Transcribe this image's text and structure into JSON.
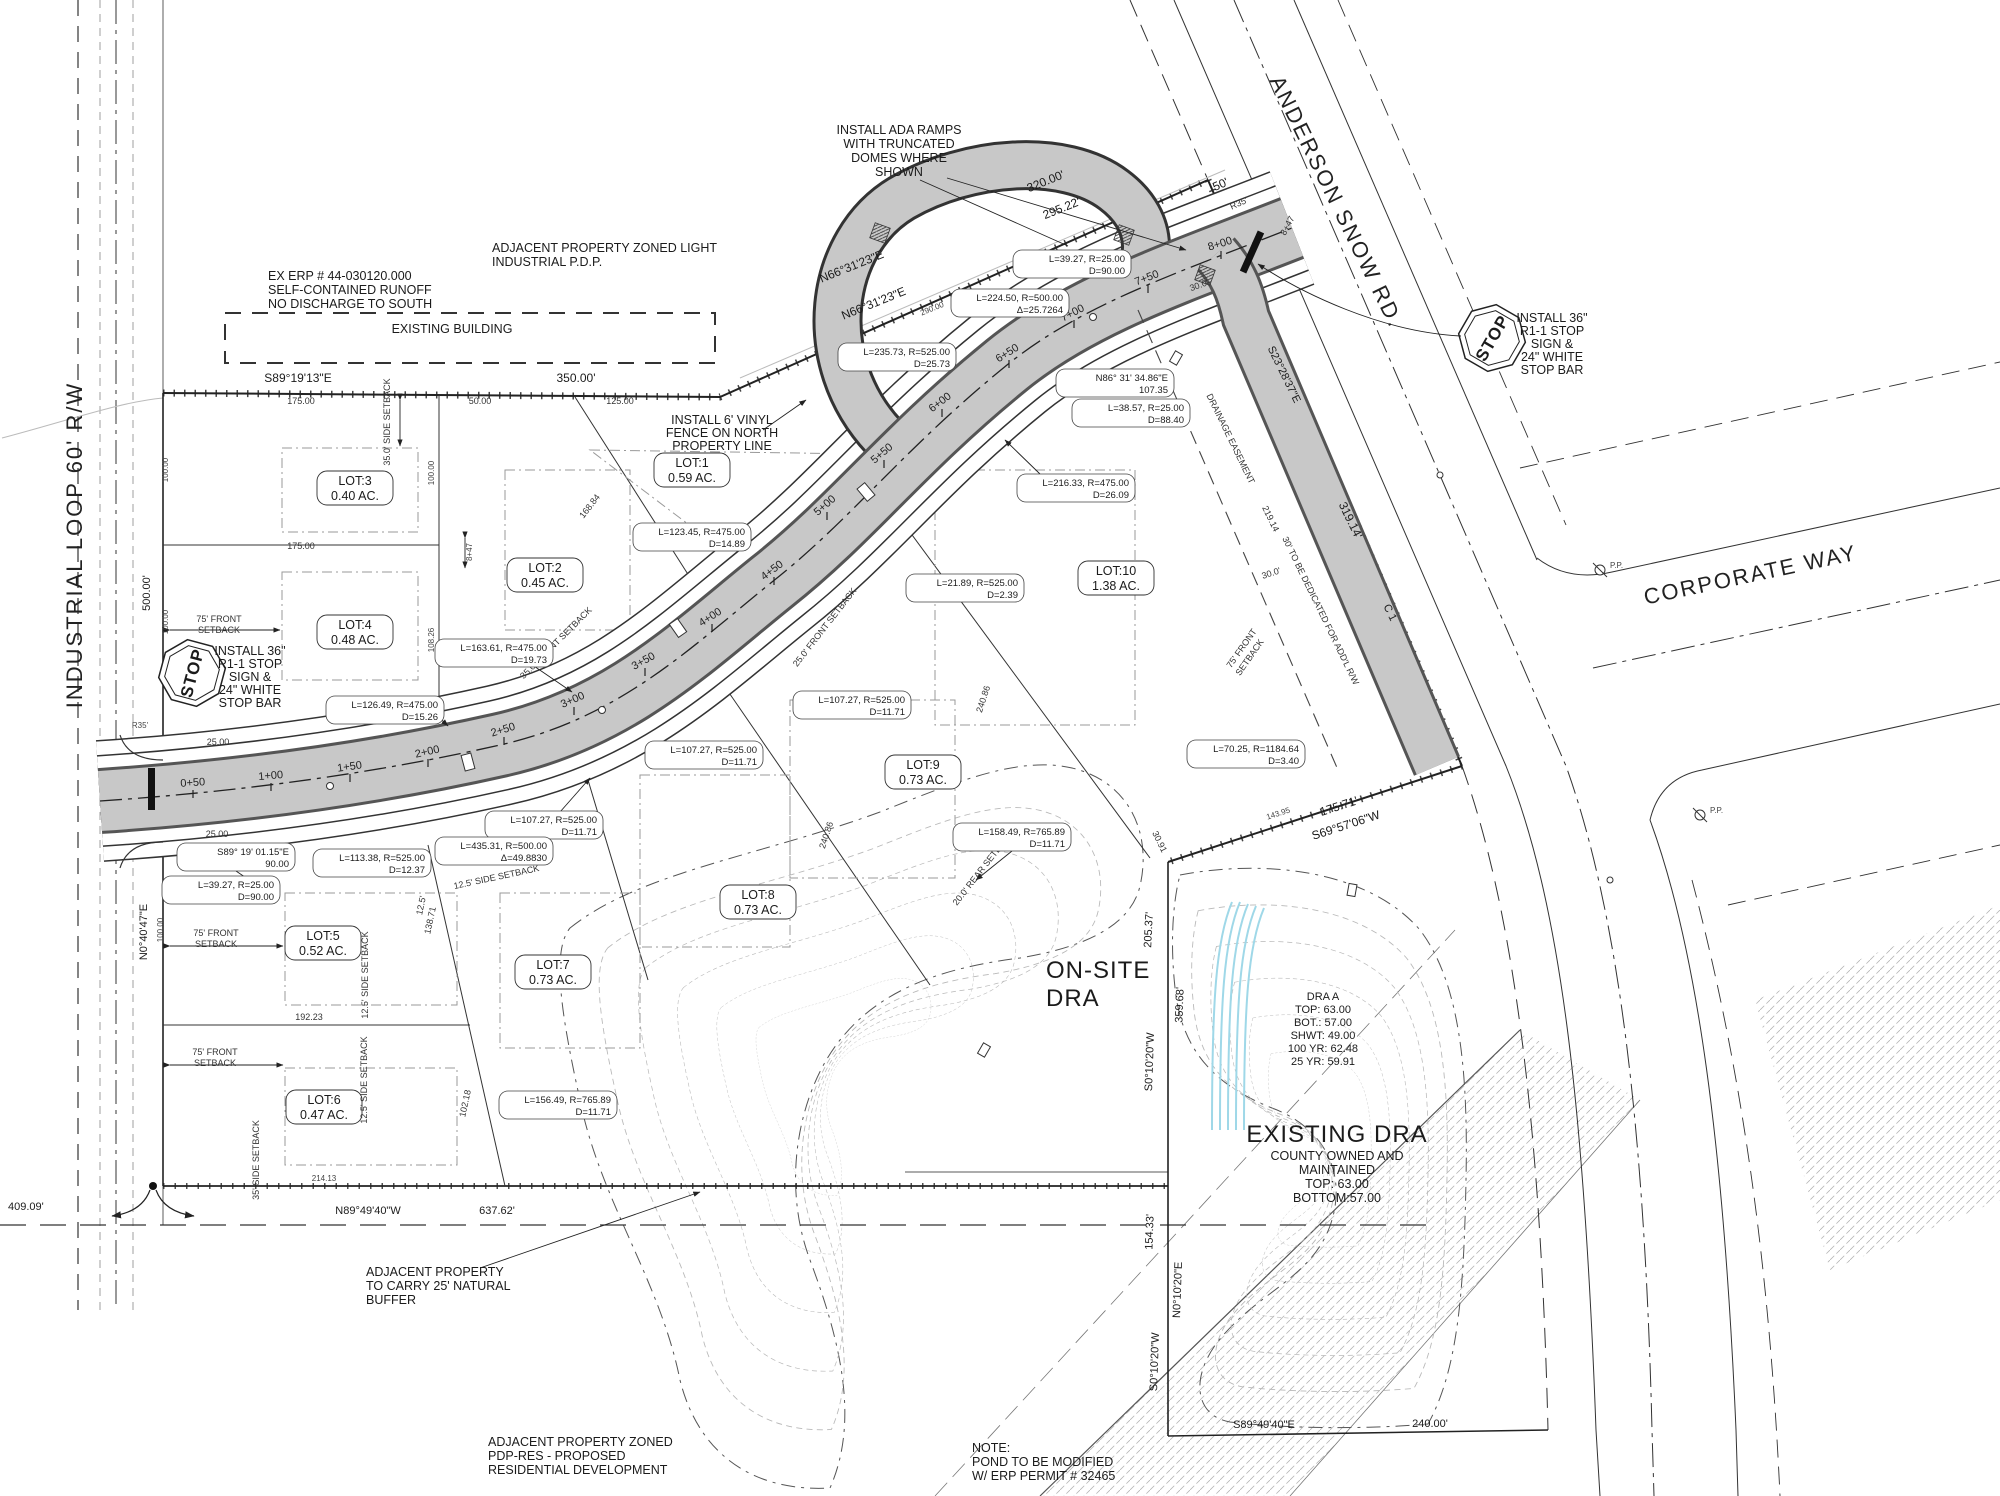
{
  "roads": {
    "industrial_loop": "INDUSTRIAL LOOP 60' R/W",
    "anderson_snow": "ANDERSON SNOW RD.",
    "corporate_way": "CORPORATE WAY",
    "curve_tag": "C 1"
  },
  "lots": [
    {
      "name": "LOT:1",
      "area": "0.59 AC."
    },
    {
      "name": "LOT:2",
      "area": "0.45 AC."
    },
    {
      "name": "LOT:3",
      "area": "0.40 AC."
    },
    {
      "name": "LOT:4",
      "area": "0.48 AC."
    },
    {
      "name": "LOT:5",
      "area": "0.52 AC."
    },
    {
      "name": "LOT:6",
      "area": "0.47 AC."
    },
    {
      "name": "LOT:7",
      "area": "0.73 AC."
    },
    {
      "name": "LOT:8",
      "area": "0.73 AC."
    },
    {
      "name": "LOT:9",
      "area": "0.73 AC."
    },
    {
      "name": "LOT:10",
      "area": "1.38 AC."
    }
  ],
  "stations": [
    "0+50",
    "1+00",
    "1+50",
    "2+00",
    "2+50",
    "3+00",
    "3+50",
    "4+00",
    "4+50",
    "5+00",
    "5+50",
    "6+00",
    "6+50",
    "7+00",
    "7+50",
    "8+00",
    "8+47"
  ],
  "curves": [
    {
      "a": "L=39.27, R=25.00",
      "b": "D=90.00"
    },
    {
      "a": "L=224.50, R=500.00",
      "b": "Δ=25.7264"
    },
    {
      "a": "L=235.73, R=525.00",
      "b": "D=25.73"
    },
    {
      "a": "N86° 31' 34.86\"E",
      "b": "107.35"
    },
    {
      "a": "L=38.57, R=25.00",
      "b": "D=88.40"
    },
    {
      "a": "L=216.33, R=475.00",
      "b": "D=26.09"
    },
    {
      "a": "L=21.89, R=525.00",
      "b": "D=2.39"
    },
    {
      "a": "L=123.45, R=475.00",
      "b": "D=14.89"
    },
    {
      "a": "L=163.61, R=475.00",
      "b": "D=19.73"
    },
    {
      "a": "L=126.49, R=475.00",
      "b": "D=15.26"
    },
    {
      "a": "L=107.27, R=525.00",
      "b": "D=11.71"
    },
    {
      "a": "L=107.27, R=525.00",
      "b": "D=11.71"
    },
    {
      "a": "L=107.27, R=525.00",
      "b": "D=11.71"
    },
    {
      "a": "L=435.31, R=500.00",
      "b": "Δ=49.8830"
    },
    {
      "a": "L=113.38, R=525.00",
      "b": "D=12.37"
    },
    {
      "a": "S89° 19' 01.15\"E",
      "b": "90.00"
    },
    {
      "a": "L=39.27, R=25.00",
      "b": "D=90.00"
    },
    {
      "a": "L=156.49, R=765.89",
      "b": "D=11.71"
    },
    {
      "a": "L=158.49, R=765.89",
      "b": "D=11.71"
    },
    {
      "a": "L=70.25, R=1184.64",
      "b": "D=3.40"
    }
  ],
  "dims": [
    "S89°19'13\"E",
    "350.00'",
    "175.00",
    "50.00",
    "125.00",
    "175.00",
    "320.00'",
    "295.22'",
    "N66°31'23\"E",
    "N66°31'23\"E",
    "290.00",
    "50'",
    "R35'",
    "30.0'",
    "S23°28'37\"E",
    "319.14'",
    "219.14",
    "30.0'",
    "175.71'",
    "S69°57'06\"W",
    "143.95",
    "30.91",
    "205.37'",
    "359.68'",
    "S0°10'20\"W",
    "154.33'",
    "N0°10'20\"E",
    "S0°10'20\"W",
    "S89°49'40\"E",
    "240.00'",
    "409.09'",
    "N89°49'40\"W",
    "637.62'",
    "214.13",
    "N0°40'47\"E",
    "500.00'",
    "100.00",
    "100.00",
    "100.00",
    "100.00",
    "108.26",
    "168.84",
    "240.86",
    "240.86",
    "102.18",
    "138.71",
    "12.5'",
    "192.23",
    "25.00",
    "25.00",
    "R35'",
    "8+47",
    "25.0'"
  ],
  "sb": {
    "front75_1": "75' FRONT",
    "front75_2": "SETBACK",
    "side35": "35.0' SIDE SETBACK",
    "side35b": "35' SIDE SETBACK",
    "side125": "12.5' SIDE SETBACK",
    "front25": "25.0' FRONT SETBACK",
    "front35": "35.0' FRONT SETBACK",
    "rear20": "20.0' REAR SETBACK"
  },
  "notes": {
    "ada": [
      "INSTALL ADA RAMPS",
      "WITH TRUNCATED",
      "DOMES WHERE",
      "SHOWN"
    ],
    "erp": [
      "EX ERP # 44-030120.000",
      "SELF-CONTAINED RUNOFF",
      "NO DISCHARGE TO SOUTH"
    ],
    "adjacent_light": [
      "ADJACENT PROPERTY ZONED LIGHT",
      "INDUSTRIAL P.D.P."
    ],
    "existing_building": "EXISTING BUILDING",
    "vinyl": [
      "INSTALL 6' VINYL",
      "FENCE ON NORTH",
      "PROPERTY LINE"
    ],
    "stop": [
      "INSTALL 36\"",
      "R1-1 STOP",
      "SIGN &",
      "24\" WHITE",
      "STOP BAR"
    ],
    "stop_word": "STOP",
    "buffer": [
      "ADJACENT PROPERTY",
      "TO CARRY 25' NATURAL",
      "BUFFER"
    ],
    "pdp": [
      "ADJACENT PROPERTY ZONED",
      "PDP-RES - PROPOSED",
      "RESIDENTIAL DEVELOPMENT"
    ],
    "pond": [
      "NOTE:",
      "POND TO BE MODIFIED",
      "W/ ERP PERMIT # 32465"
    ],
    "onsite": [
      "ON-SITE",
      "DRA"
    ],
    "dra_a": [
      "DRA A",
      "TOP: 63.00",
      "BOT.: 57.00",
      "SHWT: 49.00",
      "100 YR: 62.48",
      "25 YR: 59.91"
    ],
    "existing_dra": [
      "EXISTING DRA",
      "COUNTY OWNED AND",
      "MAINTAINED",
      "TOP: 63.00",
      "BOTTOM:57.00"
    ],
    "dedicated": "30' TO BE DEDICATED FOR ADD'L R/W",
    "drainage_easement": "DRAINAGE EASEMENT",
    "pp": "P.P."
  }
}
